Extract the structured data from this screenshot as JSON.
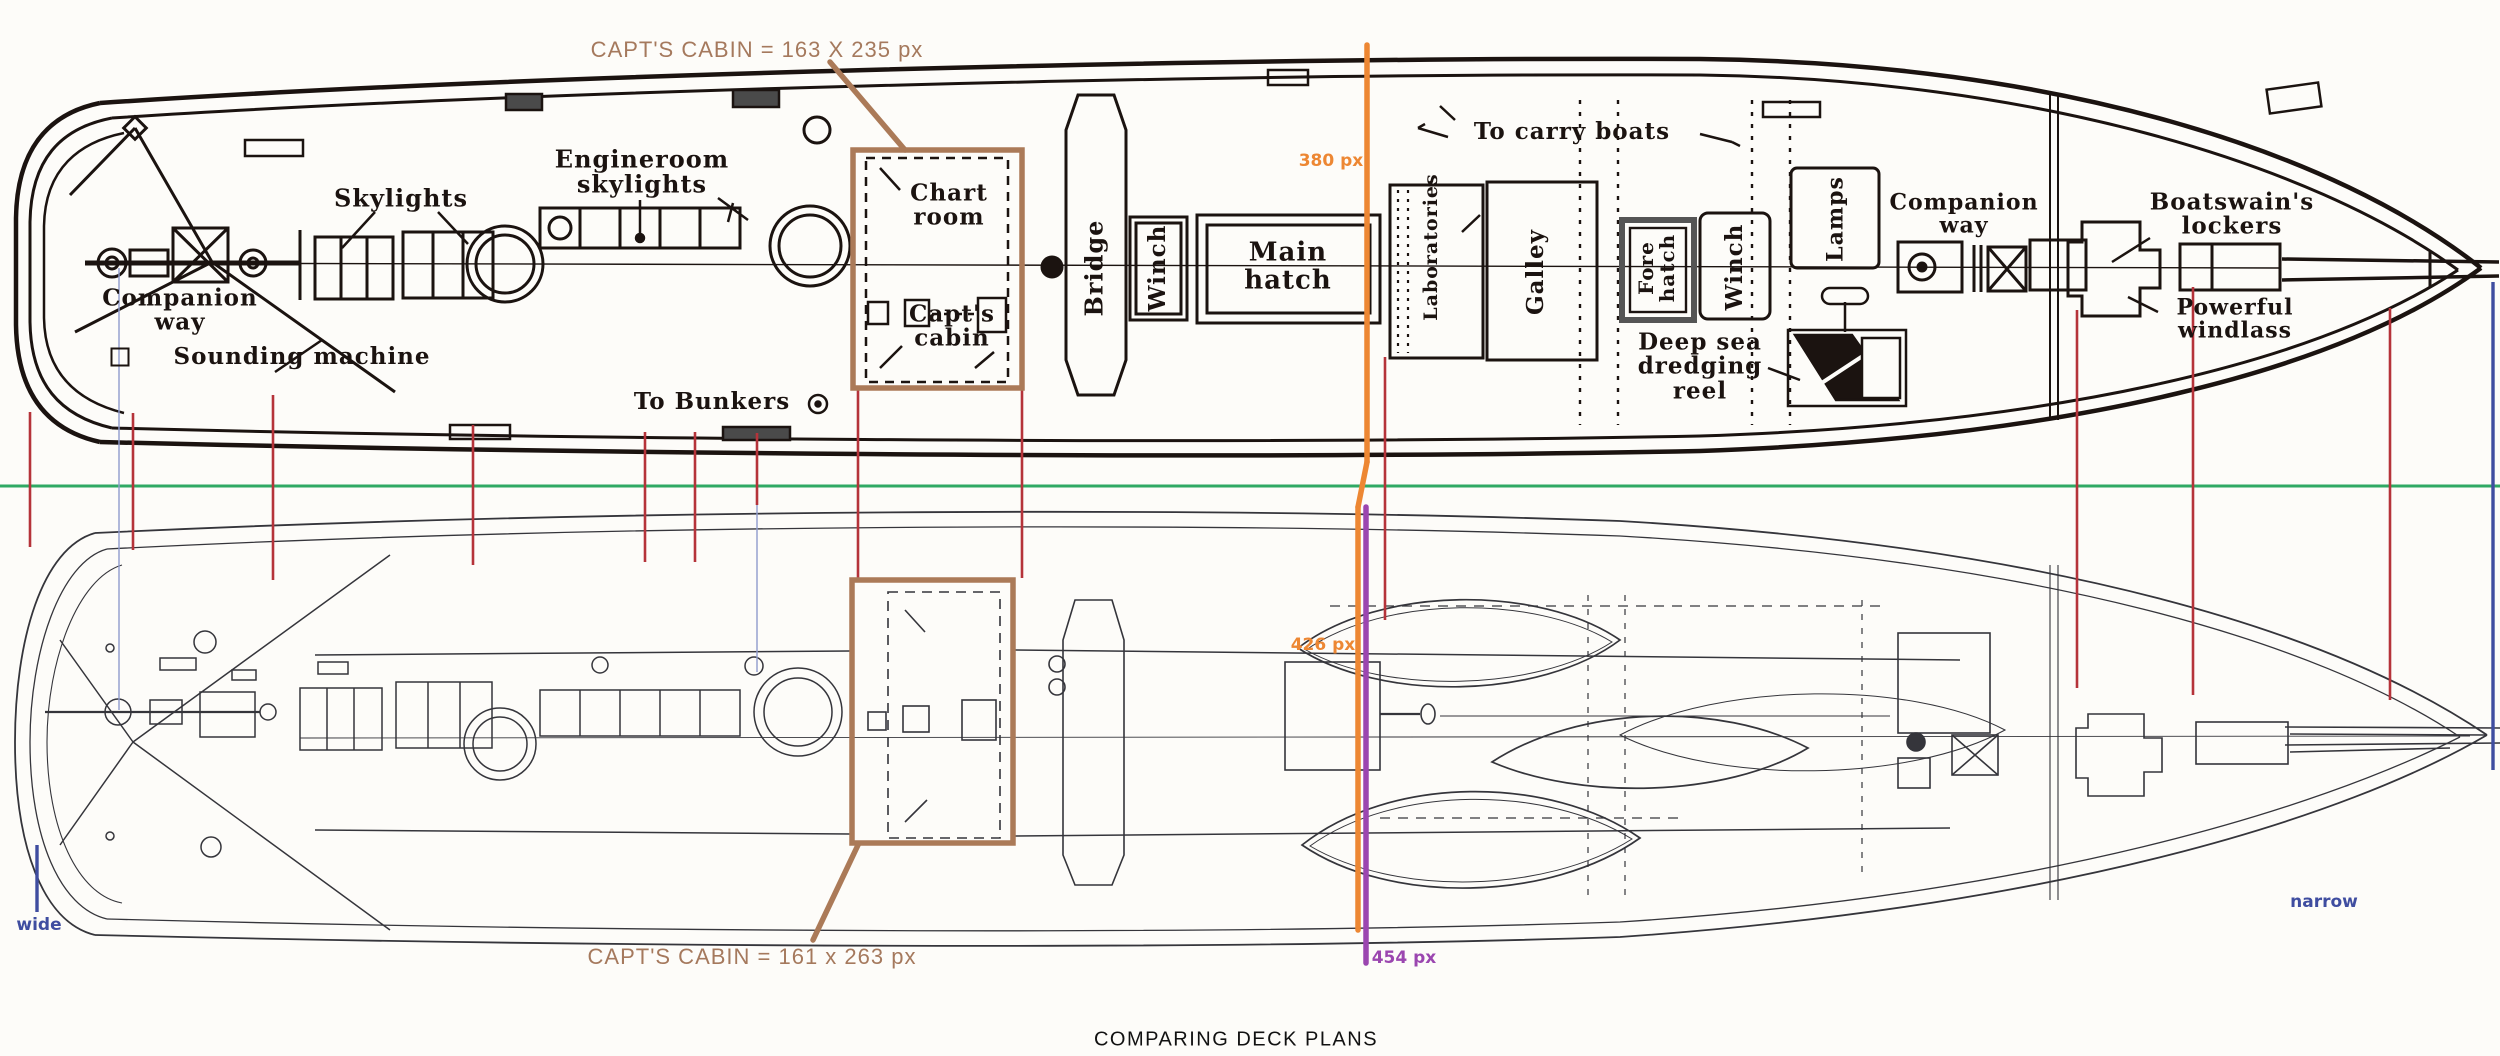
{
  "page": {
    "caption": "COMPARING DECK PLANS",
    "description": "Two ship deck plans overlaid with measurement annotations"
  },
  "colors": {
    "paper": "#fdfcf9",
    "ink": "#1b1310",
    "inkBottom": "#35353b",
    "green": "#2fa964",
    "orange": "#ed8733",
    "purple": "#9b46b0",
    "red": "#b5333a",
    "blueGuide": "#8f9cce",
    "blueMarker": "#3f4da0",
    "brownBox": "#ab7a58",
    "brownText": "#a5795d"
  },
  "top_plan": {
    "labels": {
      "skylights": "Skylights",
      "engineroom": "Engineroom\nskylights",
      "companion_left": "Companion\nway",
      "sounding": "Sounding machine",
      "to_bunkers": "To Bunkers",
      "chart_room": "Chart\nroom",
      "capts_cabin": "Capt's\ncabin",
      "bridge": "Bridge",
      "winch1": "Winch",
      "main_hatch": "Main\nhatch",
      "to_carry_boats": "To carry boats",
      "laboratories": "Laboratories",
      "galley": "Galley",
      "fore_hatch": "Fore\nhatch",
      "winch2": "Winch",
      "lamps": "Lamps",
      "companion_right": "Companion\nway",
      "deep_sea": "Deep sea\ndredging\nreel",
      "boatswains": "Boatswain's\nlockers",
      "powerful": "Powerful\nwindlass"
    }
  },
  "annotations": {
    "top_cabin": "CAPT'S CABIN = 163 X 235 px",
    "bottom_cabin": "CAPT'S CABIN = 161 x 263 px",
    "m380": "380 px",
    "m426": "426 px",
    "m454": "454 px",
    "wide": "wide",
    "narrow": "narrow"
  },
  "comparison_lines": {
    "green_reference": {
      "y": 486,
      "x1": 0,
      "x2": 2500
    },
    "orange_measure_segments": [
      [
        1367,
        45,
        1367,
        462
      ],
      [
        1367,
        462,
        1358,
        507
      ],
      [
        1358,
        507,
        1358,
        930
      ]
    ],
    "purple_measure_segments": [
      [
        1366,
        507,
        1366,
        963
      ]
    ],
    "red_connectors": [
      [
        30,
        412,
        547
      ],
      [
        133,
        413,
        550
      ],
      [
        273,
        395,
        580
      ],
      [
        473,
        425,
        565
      ],
      [
        645,
        432,
        562
      ],
      [
        695,
        432,
        562
      ],
      [
        757,
        433,
        505
      ],
      [
        858,
        390,
        578
      ],
      [
        1022,
        390,
        578
      ],
      [
        1385,
        357,
        620
      ],
      [
        2077,
        310,
        688
      ],
      [
        2193,
        287,
        695
      ],
      [
        2390,
        308,
        700
      ]
    ],
    "blue_guides": [
      [
        119,
        268,
        710
      ],
      [
        757,
        505,
        672
      ]
    ],
    "blue_width_markers": [
      [
        37,
        845,
        912
      ],
      [
        2493,
        282,
        770
      ]
    ]
  },
  "highlight_boxes": {
    "boxes": [
      [
        853,
        150,
        169,
        238
      ],
      [
        852,
        580,
        161,
        263
      ]
    ],
    "leaders": [
      [
        830,
        62,
        905,
        150
      ],
      [
        858,
        845,
        813,
        940
      ]
    ]
  }
}
